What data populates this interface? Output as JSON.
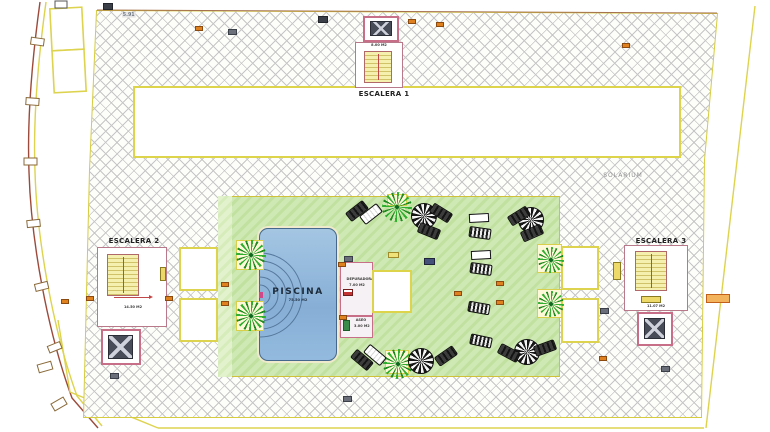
{
  "deck": {
    "label": "SOLARIUM"
  },
  "pool": {
    "name": "PISCINA",
    "area": "75.50 M2"
  },
  "stairs": {
    "e1": {
      "label": "ESCALERA 1",
      "area": "8.00 M2"
    },
    "e2": {
      "label": "ESCALERA 2",
      "area": "14.50 M2"
    },
    "e3": {
      "label": "ESCALERA 3",
      "area": "11.07 M2"
    }
  },
  "rooms": {
    "depuradora": {
      "name": "DEPURADORA",
      "area": "7.00 M2"
    },
    "aseo": {
      "name": "ASEO",
      "area": "3.00 M2"
    }
  },
  "notes": {
    "corner": "5.91"
  },
  "colors": {
    "boundary_yellow": "#ded44c",
    "wall_pink": "#c76f88",
    "hatch_gray": "#c6c6c6",
    "lawn_green": "#cfe9b4",
    "pool_blue": "#87afd6",
    "palm_green": "#2fae2f",
    "marker_orange": "#e0811f"
  },
  "furniture": {
    "planters": [
      {
        "x": 236,
        "y": 240,
        "w": 28,
        "h": 30
      },
      {
        "x": 236,
        "y": 301,
        "w": 28,
        "h": 30
      },
      {
        "x": 537,
        "y": 244,
        "w": 25,
        "h": 29
      },
      {
        "x": 537,
        "y": 289,
        "w": 25,
        "h": 29
      },
      {
        "x": 387,
        "y": 194,
        "w": 20,
        "h": 12
      },
      {
        "x": 385,
        "y": 350,
        "w": 24,
        "h": 24
      }
    ],
    "palms": [
      {
        "x": 397,
        "y": 207,
        "s": 30
      },
      {
        "x": 251,
        "y": 255,
        "s": 30
      },
      {
        "x": 251,
        "y": 316,
        "s": 30
      },
      {
        "x": 551,
        "y": 260,
        "s": 26
      },
      {
        "x": 551,
        "y": 304,
        "s": 26
      },
      {
        "x": 398,
        "y": 364,
        "s": 30
      }
    ],
    "parasols": [
      {
        "x": 424,
        "y": 216
      },
      {
        "x": 531,
        "y": 220
      },
      {
        "x": 421,
        "y": 361
      },
      {
        "x": 527,
        "y": 352
      }
    ],
    "loungers": [
      {
        "x": 357,
        "y": 211,
        "rot": -38,
        "v": "dark"
      },
      {
        "x": 371,
        "y": 214,
        "rot": -38,
        "v": "white"
      },
      {
        "x": 441,
        "y": 213,
        "rot": 32,
        "v": "dark"
      },
      {
        "x": 429,
        "y": 231,
        "rot": 22,
        "v": "dark"
      },
      {
        "x": 519,
        "y": 216,
        "rot": -32,
        "v": "dark"
      },
      {
        "x": 532,
        "y": 233,
        "rot": -24,
        "v": "dark"
      },
      {
        "x": 480,
        "y": 233,
        "rot": 8,
        "v": "pattern"
      },
      {
        "x": 481,
        "y": 269,
        "rot": 8,
        "v": "pattern"
      },
      {
        "x": 479,
        "y": 308,
        "rot": 10,
        "v": "pattern"
      },
      {
        "x": 481,
        "y": 341,
        "rot": 12,
        "v": "pattern"
      },
      {
        "x": 362,
        "y": 360,
        "rot": 40,
        "v": "dark"
      },
      {
        "x": 375,
        "y": 355,
        "rot": 40,
        "v": "white"
      },
      {
        "x": 446,
        "y": 356,
        "rot": -35,
        "v": "dark"
      },
      {
        "x": 509,
        "y": 353,
        "rot": 28,
        "v": "dark"
      },
      {
        "x": 545,
        "y": 348,
        "rot": -20,
        "v": "dark"
      }
    ],
    "tables": [
      {
        "x": 479,
        "y": 218,
        "rot": -3
      },
      {
        "x": 481,
        "y": 255,
        "rot": -3
      }
    ],
    "markers": [
      {
        "x": 103,
        "y": 3,
        "t": "dark"
      },
      {
        "x": 318,
        "y": 16,
        "t": "dark"
      },
      {
        "x": 195,
        "y": 26,
        "t": "orange"
      },
      {
        "x": 228,
        "y": 29,
        "t": "gray"
      },
      {
        "x": 408,
        "y": 19,
        "t": "orange"
      },
      {
        "x": 436,
        "y": 22,
        "t": "orange"
      },
      {
        "x": 622,
        "y": 43,
        "t": "orange"
      },
      {
        "x": 86,
        "y": 296,
        "t": "orange"
      },
      {
        "x": 61,
        "y": 299,
        "t": "orange"
      },
      {
        "x": 165,
        "y": 296,
        "t": "orange"
      },
      {
        "x": 221,
        "y": 282,
        "t": "orange"
      },
      {
        "x": 221,
        "y": 301,
        "t": "orange"
      },
      {
        "x": 338,
        "y": 262,
        "t": "orange"
      },
      {
        "x": 339,
        "y": 315,
        "t": "orange"
      },
      {
        "x": 454,
        "y": 291,
        "t": "orange"
      },
      {
        "x": 496,
        "y": 281,
        "t": "orange"
      },
      {
        "x": 496,
        "y": 300,
        "t": "orange"
      },
      {
        "x": 599,
        "y": 356,
        "t": "orange"
      },
      {
        "x": 344,
        "y": 256,
        "t": "gray"
      },
      {
        "x": 600,
        "y": 308,
        "t": "gray"
      },
      {
        "x": 661,
        "y": 366,
        "t": "gray"
      },
      {
        "x": 343,
        "y": 396,
        "t": "gray"
      },
      {
        "x": 110,
        "y": 373,
        "t": "gray"
      },
      {
        "x": 388,
        "y": 252,
        "t": "yellow"
      },
      {
        "x": 424,
        "y": 258,
        "t": "blue"
      },
      {
        "x": 706,
        "y": 294,
        "t": "orange-wide"
      }
    ]
  }
}
